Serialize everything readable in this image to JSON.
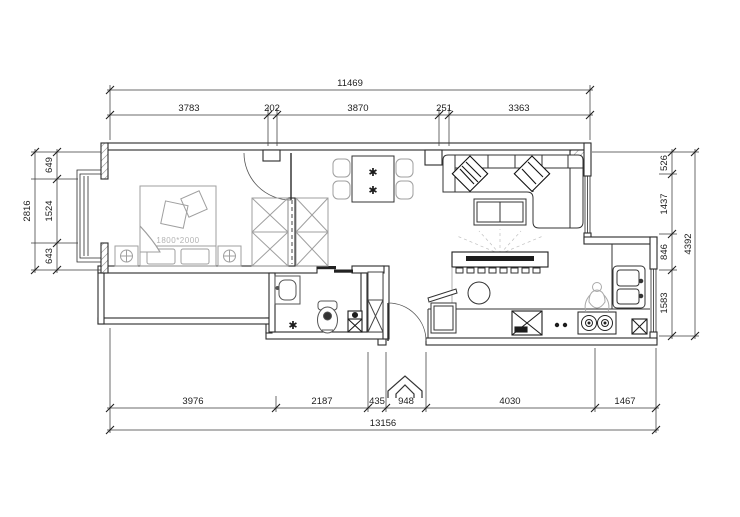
{
  "drawing_title": "apartment-floor-plan",
  "dims": {
    "top": {
      "total": "11469",
      "segments": [
        "3783",
        "202",
        "3870",
        "251",
        "3363"
      ]
    },
    "bottom": {
      "total": "13156",
      "segments": [
        "3976",
        "2187",
        "435",
        "948",
        "4030",
        "1467"
      ]
    },
    "left": {
      "total": "2816",
      "segments": [
        "649",
        "1524",
        "643"
      ]
    },
    "right": {
      "total": "4392",
      "segments": [
        "526",
        "1437",
        "846",
        "1583"
      ]
    }
  },
  "labels": {
    "bed_size": "1800*2000"
  },
  "icons": {
    "plant": "✱"
  },
  "colors": {
    "wall_line": "#2b2b2b",
    "furniture_gray": "#9f9f9f",
    "dim_line": "#3a3a3a",
    "background": "#ffffff"
  }
}
